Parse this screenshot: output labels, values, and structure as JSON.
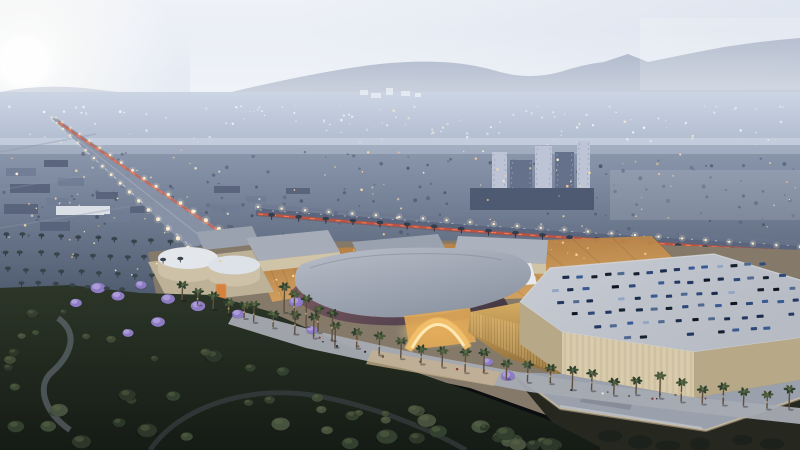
{
  "scene": {
    "subjects": [
      "dusk-sky",
      "hazy-mountains",
      "distant-city-lights",
      "boulevard-with-traffic",
      "highway-tail-lights",
      "shopping-mall-complex",
      "rooftop-parking-with-cars",
      "palm-lined-promenade",
      "dark-green-park"
    ]
  },
  "colors": {
    "sky_top": "#eef1f7",
    "sky_mid": "#e3e9f3",
    "sky_horizon": "#d5deec",
    "sky_right_tint": "#c6d1e2",
    "sun_core": "#ffffff",
    "mountain_far": "#aab5ca",
    "mountain_near": "#8f9cb6",
    "distant_city": "#ccd5e4",
    "distant_city_low": "#aeb9cd",
    "mid_city_top": "#8d99af",
    "mid_city_bottom": "#4e5a6e",
    "city_block_dark": "#57627a",
    "city_block_light": "#707c94",
    "white_roof": "#e7eaef",
    "tower_light": "#bdc4d5",
    "tower_dark": "#65718b",
    "tower_podium": "#4e5a72",
    "speckle_dark": "#46526a",
    "avenue": "#8a94a8",
    "avenue_median": "#b3bac8",
    "tail_light": "#e14e2c",
    "tail_bright": "#ff7a50",
    "street_light": "#fff1d2",
    "highway": "#59647c",
    "service_road": "#6b7690",
    "frontage": "#7e8898",
    "mall_ground": "#857a69",
    "roof_a": "#a6adb9",
    "roof_b": "#9aa2af",
    "roof_c": "#abb2be",
    "wall_beige": "#cfc3a8",
    "drum_roof": "#e3e6eb",
    "drum_roof2": "#dde1e8",
    "drum_wall": "#cdc1a8",
    "podium_beige": "#bdb198",
    "curved_hi": "#b8bec9",
    "curved_lo": "#8d95a3",
    "fascia_hi": "#7d5a63",
    "fascia_lo": "#463a46",
    "gold_deep": "#b27a3e",
    "gold_mid": "#d9a55f",
    "gold_bright": "#ffdf9e",
    "gold_lattice": "#7a4f28",
    "gold_wall_hi": "#d5ab61",
    "gold_wall_lo": "#8a6a38",
    "entrance_glow": "#ffd98a",
    "arch": "#f3c16c",
    "arch_inner": "#ffedbc",
    "orange_kiosk": "#d97b35",
    "parking_roof": "#b6bbc4",
    "parking_roof_hi": "#c8ccd4",
    "parking_wall": "#d6c9ab",
    "parking_wall_dark": "#b7a888",
    "annex_roof": "#9aa1ac",
    "annex_box": "#868d99",
    "tree_row": "#3d4a3a",
    "tree_row_hi": "#55654a",
    "promenade": "#a6abb2",
    "promenade_lit": "#c8b18d",
    "palm_trunk": "#5e5040",
    "palm_dark": "#2e402e",
    "palm_mid": "#49583a",
    "palm_hi": "#61714a",
    "jacaranda": "#8d7cc2",
    "jacaranda_hi": "#b2a2de",
    "park_top": "#2c3628",
    "park_bottom": "#151b15",
    "park_tree_hi": "#5a6848",
    "stream": "#77828d",
    "park_path": "#4e5861",
    "ground_dark": "#26281f",
    "car_palette": [
      "#1c2c4c",
      "#243862",
      "#2e4878",
      "#3a5a94",
      "#16202f",
      "#0e1624",
      "#51698f",
      "#93a5c0"
    ],
    "park_tree_palette": [
      "#33402f",
      "#3c4a36",
      "#2c3629",
      "#46523d"
    ],
    "people_palette": [
      "#20242b",
      "#eae6dc",
      "#6a5844",
      "#8a2f2a"
    ]
  },
  "procedural": {
    "seed": 7,
    "distant_lights": {
      "count": 130
    },
    "bright_blobs": [
      [
        360,
        90,
        8,
        5
      ],
      [
        371,
        93,
        10,
        5
      ],
      [
        386,
        88,
        7,
        7
      ],
      [
        401,
        91,
        9,
        5
      ],
      [
        415,
        93,
        6,
        4
      ]
    ],
    "mid_lights": {
      "count": 90
    },
    "tree_speckles": {
      "count": 160
    },
    "left_blocks": [
      {
        "x": 6,
        "y": 168,
        "w": 30,
        "h": 8,
        "c": "light"
      },
      {
        "x": 44,
        "y": 160,
        "w": 24,
        "h": 7,
        "c": "dark"
      },
      {
        "x": 10,
        "y": 184,
        "w": 40,
        "h": 9,
        "c": "dark"
      },
      {
        "x": 58,
        "y": 178,
        "w": 26,
        "h": 8,
        "c": "light"
      },
      {
        "x": 4,
        "y": 204,
        "w": 34,
        "h": 10,
        "c": "dark"
      },
      {
        "x": 46,
        "y": 198,
        "w": 22,
        "h": 8,
        "c": "light"
      },
      {
        "x": 56,
        "y": 206,
        "w": 54,
        "h": 9,
        "c": "white"
      },
      {
        "x": 40,
        "y": 222,
        "w": 30,
        "h": 9,
        "c": "dark"
      },
      {
        "x": 96,
        "y": 192,
        "w": 22,
        "h": 7,
        "c": "dark"
      },
      {
        "x": 120,
        "y": 182,
        "w": 18,
        "h": 6,
        "c": "light"
      },
      {
        "x": 104,
        "y": 214,
        "w": 26,
        "h": 8,
        "c": "light"
      },
      {
        "x": 130,
        "y": 206,
        "w": 20,
        "h": 7,
        "c": "dark"
      },
      {
        "x": 150,
        "y": 196,
        "w": 24,
        "h": 7,
        "c": "dark"
      },
      {
        "x": 214,
        "y": 186,
        "w": 26,
        "h": 7,
        "c": "dark"
      },
      {
        "x": 246,
        "y": 196,
        "w": 20,
        "h": 6,
        "c": "light"
      },
      {
        "x": 286,
        "y": 188,
        "w": 24,
        "h": 6,
        "c": "dark"
      },
      {
        "x": 210,
        "y": 204,
        "w": 30,
        "h": 8,
        "c": "light"
      }
    ],
    "towers": [
      {
        "x": 492,
        "y": 152,
        "w": 15,
        "h": 46,
        "c": "light"
      },
      {
        "x": 510,
        "y": 160,
        "w": 22,
        "h": 40,
        "c": "dark"
      },
      {
        "x": 535,
        "y": 146,
        "w": 17,
        "h": 55,
        "c": "light"
      },
      {
        "x": 555,
        "y": 152,
        "w": 19,
        "h": 48,
        "c": "dark"
      },
      {
        "x": 577,
        "y": 141,
        "w": 13,
        "h": 58,
        "c": "light"
      },
      {
        "x": 470,
        "y": 188,
        "w": 124,
        "h": 22,
        "c": "podium"
      }
    ],
    "avenue": {
      "left_edge": [
        [
          52,
          118
        ],
        [
          188,
          248
        ]
      ],
      "right_edge": [
        [
          56,
          118
        ],
        [
          232,
          238
        ]
      ],
      "lights": 17
    },
    "cross_streets": [
      [
        0,
        152,
        96,
        134
      ],
      [
        0,
        190,
        150,
        164
      ],
      [
        0,
        228,
        182,
        198
      ]
    ],
    "highway": {
      "p": [
        [
          258,
          212
        ],
        [
          430,
          224
        ],
        [
          580,
          236
        ],
        [
          800,
          252
        ]
      ],
      "lights": 24,
      "palms": 20
    },
    "frontage": {
      "a": [
        524,
        262
      ],
      "b": [
        800,
        278
      ],
      "trees": 22
    },
    "gold_patches": [
      {
        "pts": [
          [
            160,
            262
          ],
          [
            250,
            252
          ],
          [
            268,
            290
          ],
          [
            175,
            298
          ]
        ],
        "n": 10,
        "fill": false
      },
      {
        "pts": [
          [
            256,
            262
          ],
          [
            344,
            250
          ],
          [
            362,
            286
          ],
          [
            272,
            302
          ]
        ],
        "n": 16,
        "fill": true
      },
      {
        "pts": [
          [
            334,
            248
          ],
          [
            652,
            236
          ],
          [
            706,
            292
          ],
          [
            420,
            302
          ]
        ],
        "n": 70,
        "fill": true
      }
    ],
    "back_boxes": [
      {
        "roof": "246,238 328,230 340,252 258,261",
        "wall": "258,261 340,252 340,263 258,272",
        "rc": "roof_a"
      },
      {
        "roof": "352,242 438,234 450,258 364,267",
        "wall": "364,267 450,258 450,269 364,278",
        "rc": "roof_b"
      },
      {
        "roof": "458,236 548,240 546,264 452,260",
        "wall": "452,260 546,264 546,274 452,270",
        "rc": "roof_c"
      },
      {
        "roof": "497,266 531,263 537,284 503,287",
        "wall": "",
        "rc": "white_roof"
      }
    ],
    "parking_rows": [
      {
        "a": [
          566,
          278
        ],
        "b": [
          762,
          264
        ],
        "n": 15
      },
      {
        "a": [
          556,
          290
        ],
        "b": [
          782,
          276
        ],
        "n": 16
      },
      {
        "a": [
          560,
          302
        ],
        "b": [
          792,
          288
        ],
        "n": 16
      },
      {
        "a": [
          576,
          314
        ],
        "b": [
          796,
          300
        ],
        "n": 15
      },
      {
        "a": [
          598,
          326
        ],
        "b": [
          792,
          314
        ],
        "n": 13
      },
      {
        "a": [
          628,
          338
        ],
        "b": [
          768,
          328
        ],
        "n": 10
      }
    ],
    "promenade_palms": {
      "path": [
        [
          252,
          322
        ],
        [
          340,
          346
        ],
        [
          450,
          368
        ],
        [
          580,
          390
        ],
        [
          788,
          410
        ]
      ],
      "count": 26
    },
    "back_palms": {
      "path": [
        [
          182,
          300
        ],
        [
          244,
          318
        ]
      ],
      "count": 5
    },
    "front_cluster": [
      [
        294,
        318
      ],
      [
        306,
        326
      ],
      [
        318,
        332
      ],
      [
        332,
        340
      ],
      [
        284,
        312
      ]
    ],
    "jacarandas": [
      [
        98,
        288
      ],
      [
        118,
        296
      ],
      [
        141,
        285
      ],
      [
        168,
        299
      ],
      [
        198,
        306
      ],
      [
        76,
        303
      ],
      [
        238,
        314
      ],
      [
        158,
        322
      ],
      [
        128,
        333
      ],
      [
        296,
        302
      ],
      [
        312,
        330
      ],
      [
        488,
        362
      ],
      [
        508,
        376
      ]
    ],
    "park_trees": {
      "count": 62,
      "x_max": 592,
      "boundary_b": 286,
      "boundary_m": 0.27
    },
    "people": {
      "count": 24
    },
    "grove_rows": [
      [
        6,
        238,
        170,
        246,
        10
      ],
      [
        4,
        256,
        180,
        263,
        11
      ],
      [
        8,
        272,
        152,
        280,
        9
      ],
      [
        20,
        286,
        122,
        293,
        7
      ]
    ],
    "grove_lights": {
      "count": 9
    },
    "corner_trees": [
      [
        610,
        436
      ],
      [
        640,
        442
      ],
      [
        668,
        446
      ],
      [
        700,
        444
      ],
      [
        742,
        440
      ],
      [
        772,
        444
      ]
    ]
  }
}
